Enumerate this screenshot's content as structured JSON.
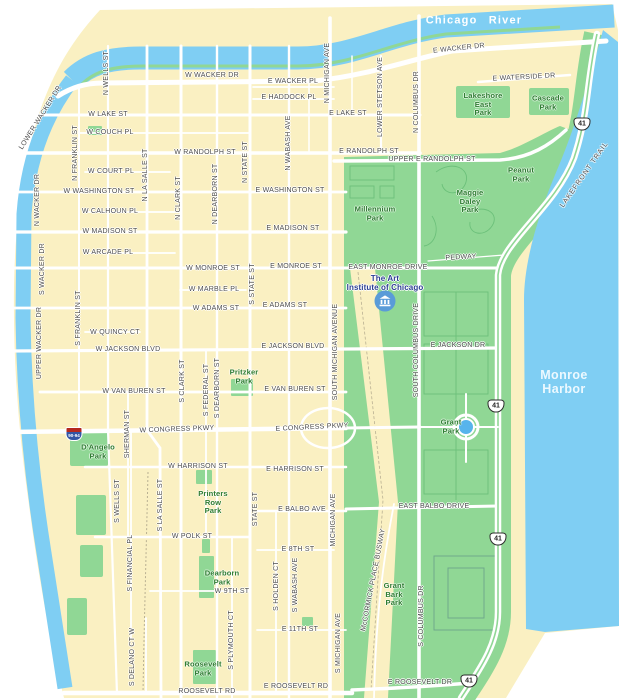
{
  "colors": {
    "land": "#FAF0C2",
    "water": "#7FCEF3",
    "park": "#90D795",
    "parkline": "#6CC07A",
    "road": "#FFFFFF",
    "bldg": "#6FA98C",
    "rail": "#B9B092",
    "stlbl": "#4E4E4E",
    "parklbl": "#2E7D32",
    "waterlbl": "#FFFFFF",
    "harborlbl": "#EDF9FF",
    "poilbl": "#2B3E92",
    "museum": "#5A9BD8",
    "shblue": "#3355A4",
    "shred": "#B5281F"
  },
  "map": {
    "labels": [
      {
        "t": "Chicago River",
        "x": 474,
        "y": 21,
        "r": 0,
        "c": "river"
      },
      {
        "t": "Monroe\nHarbor",
        "x": 564,
        "y": 382,
        "r": 0,
        "c": "harbor"
      },
      {
        "t": "W WACKER DR",
        "x": 212,
        "y": 76,
        "r": 0,
        "c": "st"
      },
      {
        "t": "E WACKER DR",
        "x": 459,
        "y": 49,
        "r": -6,
        "c": "st"
      },
      {
        "t": "E WACKER PL",
        "x": 293,
        "y": 82,
        "r": 0,
        "c": "st"
      },
      {
        "t": "E HADDOCK PL",
        "x": 289,
        "y": 98,
        "r": 0,
        "c": "st"
      },
      {
        "t": "E WATERSIDE DR",
        "x": 524,
        "y": 78,
        "r": -3,
        "c": "st"
      },
      {
        "t": "W LAKE ST",
        "x": 108,
        "y": 115,
        "r": 0,
        "c": "st"
      },
      {
        "t": "E LAKE ST",
        "x": 348,
        "y": 114,
        "r": 0,
        "c": "st"
      },
      {
        "t": "W COUCH PL",
        "x": 110,
        "y": 133,
        "r": 0,
        "c": "st"
      },
      {
        "t": "W RANDOLPH ST",
        "x": 205,
        "y": 153,
        "r": 0,
        "c": "st"
      },
      {
        "t": "E RANDOLPH ST",
        "x": 369,
        "y": 152,
        "r": 0,
        "c": "st"
      },
      {
        "t": "UPPER E RANDOLPH ST",
        "x": 432,
        "y": 160,
        "r": 0,
        "c": "st"
      },
      {
        "t": "W COURT PL",
        "x": 111,
        "y": 172,
        "r": 0,
        "c": "st"
      },
      {
        "t": "W WASHINGTON ST",
        "x": 99,
        "y": 192,
        "r": 0,
        "c": "st"
      },
      {
        "t": "E WASHINGTON ST",
        "x": 290,
        "y": 191,
        "r": 0,
        "c": "st"
      },
      {
        "t": "W CALHOUN PL",
        "x": 110,
        "y": 212,
        "r": 0,
        "c": "st"
      },
      {
        "t": "W MADISON ST",
        "x": 110,
        "y": 232,
        "r": 0,
        "c": "st"
      },
      {
        "t": "E MADISON ST",
        "x": 293,
        "y": 229,
        "r": 0,
        "c": "st"
      },
      {
        "t": "W ARCADE PL",
        "x": 108,
        "y": 253,
        "r": 0,
        "c": "st"
      },
      {
        "t": "W MONROE ST",
        "x": 213,
        "y": 269,
        "r": 0,
        "c": "st"
      },
      {
        "t": "E MONROE ST",
        "x": 296,
        "y": 267,
        "r": 0,
        "c": "st"
      },
      {
        "t": "EAST MONROE DRIVE",
        "x": 388,
        "y": 268,
        "r": 0,
        "c": "st"
      },
      {
        "t": "PEDWAY",
        "x": 461,
        "y": 258,
        "r": -3,
        "c": "st"
      },
      {
        "t": "W MARBLE PL",
        "x": 214,
        "y": 290,
        "r": 0,
        "c": "st"
      },
      {
        "t": "W ADAMS ST",
        "x": 216,
        "y": 309,
        "r": 0,
        "c": "st"
      },
      {
        "t": "E ADAMS ST",
        "x": 285,
        "y": 306,
        "r": 0,
        "c": "st"
      },
      {
        "t": "W QUINCY CT",
        "x": 115,
        "y": 333,
        "r": 0,
        "c": "st"
      },
      {
        "t": "W JACKSON BLVD",
        "x": 128,
        "y": 350,
        "r": 0,
        "c": "st"
      },
      {
        "t": "E JACKSON BLVD",
        "x": 293,
        "y": 347,
        "r": 0,
        "c": "st"
      },
      {
        "t": "E JACKSON DR",
        "x": 458,
        "y": 346,
        "r": 0,
        "c": "st"
      },
      {
        "t": "W VAN BUREN ST",
        "x": 134,
        "y": 392,
        "r": 0,
        "c": "st"
      },
      {
        "t": "E VAN BUREN ST",
        "x": 295,
        "y": 390,
        "r": 0,
        "c": "st"
      },
      {
        "t": "W CONGRESS PKWY",
        "x": 177,
        "y": 430,
        "r": -2,
        "c": "st"
      },
      {
        "t": "E CONGRESS PKWY",
        "x": 312,
        "y": 428,
        "r": -3,
        "c": "st"
      },
      {
        "t": "W HARRISON ST",
        "x": 198,
        "y": 467,
        "r": 0,
        "c": "st"
      },
      {
        "t": "E HARRISON ST",
        "x": 295,
        "y": 470,
        "r": 0,
        "c": "st"
      },
      {
        "t": "W POLK ST",
        "x": 192,
        "y": 537,
        "r": 0,
        "c": "st"
      },
      {
        "t": "E BALBO AVE",
        "x": 302,
        "y": 510,
        "r": 0,
        "c": "st"
      },
      {
        "t": "EAST BALBO DRIVE",
        "x": 434,
        "y": 507,
        "r": 0,
        "c": "st"
      },
      {
        "t": "E 8TH ST",
        "x": 298,
        "y": 550,
        "r": 0,
        "c": "st"
      },
      {
        "t": "W 9TH ST",
        "x": 232,
        "y": 592,
        "r": 0,
        "c": "st"
      },
      {
        "t": "E 11TH ST",
        "x": 300,
        "y": 630,
        "r": 0,
        "c": "st"
      },
      {
        "t": "ROOSEVELT RD",
        "x": 207,
        "y": 692,
        "r": 0,
        "c": "st"
      },
      {
        "t": "E ROOSEVELT RD",
        "x": 296,
        "y": 687,
        "r": 0,
        "c": "st"
      },
      {
        "t": "E ROOSEVELT DR",
        "x": 420,
        "y": 683,
        "r": 0,
        "c": "st"
      },
      {
        "t": "N WELLS ST",
        "x": 107,
        "y": 73,
        "r": -90,
        "c": "st"
      },
      {
        "t": "N FRANKLIN ST",
        "x": 76,
        "y": 153,
        "r": -90,
        "c": "st"
      },
      {
        "t": "N LA SALLE ST",
        "x": 146,
        "y": 175,
        "r": -90,
        "c": "st"
      },
      {
        "t": "N CLARK ST",
        "x": 179,
        "y": 198,
        "r": -90,
        "c": "st"
      },
      {
        "t": "N DEARBORN ST",
        "x": 216,
        "y": 194,
        "r": -90,
        "c": "st"
      },
      {
        "t": "N STATE ST",
        "x": 246,
        "y": 162,
        "r": -90,
        "c": "st"
      },
      {
        "t": "N WABASH AVE",
        "x": 289,
        "y": 143,
        "r": -90,
        "c": "st"
      },
      {
        "t": "N MICHIGAN AVE",
        "x": 328,
        "y": 73,
        "r": -90,
        "c": "st"
      },
      {
        "t": "LOWER STETSON AVE",
        "x": 381,
        "y": 97,
        "r": -90,
        "c": "st"
      },
      {
        "t": "N COLUMBUS DR",
        "x": 417,
        "y": 102,
        "r": -90,
        "c": "st"
      },
      {
        "t": "N WACKER DR",
        "x": 38,
        "y": 200,
        "r": -90,
        "c": "st"
      },
      {
        "t": "S WACKER DR",
        "x": 43,
        "y": 269,
        "r": -90,
        "c": "st"
      },
      {
        "t": "UPPER WACKER DR",
        "x": 40,
        "y": 343,
        "r": -90,
        "c": "st"
      },
      {
        "t": "LOWER WACKER DR",
        "x": 41,
        "y": 118,
        "r": -58,
        "c": "st"
      },
      {
        "t": "S FRANKLIN ST",
        "x": 79,
        "y": 318,
        "r": -90,
        "c": "st"
      },
      {
        "t": "S STATE ST",
        "x": 253,
        "y": 284,
        "r": -90,
        "c": "st"
      },
      {
        "t": "S CLARK ST",
        "x": 183,
        "y": 381,
        "r": -90,
        "c": "st"
      },
      {
        "t": "S FEDERAL ST",
        "x": 207,
        "y": 390,
        "r": -90,
        "c": "st"
      },
      {
        "t": "S DEARBORN ST",
        "x": 218,
        "y": 388,
        "r": -90,
        "c": "st"
      },
      {
        "t": "SHERMAN ST",
        "x": 128,
        "y": 434,
        "r": -90,
        "c": "st"
      },
      {
        "t": "S WELLS ST",
        "x": 118,
        "y": 501,
        "r": -90,
        "c": "st"
      },
      {
        "t": "S LA SALLE ST",
        "x": 161,
        "y": 505,
        "r": -90,
        "c": "st"
      },
      {
        "t": "S FINANCIAL PL",
        "x": 131,
        "y": 563,
        "r": -90,
        "c": "st"
      },
      {
        "t": "STATE ST",
        "x": 256,
        "y": 509,
        "r": -90,
        "c": "st"
      },
      {
        "t": "S HOLDEN CT",
        "x": 277,
        "y": 586,
        "r": -90,
        "c": "st"
      },
      {
        "t": "S WABASH AVE",
        "x": 296,
        "y": 585,
        "r": -90,
        "c": "st"
      },
      {
        "t": "SOUTH MICHIGAN AVENUE",
        "x": 336,
        "y": 352,
        "r": -90,
        "c": "st"
      },
      {
        "t": "MICHIGAN AVE",
        "x": 334,
        "y": 520,
        "r": -90,
        "c": "st"
      },
      {
        "t": "S MICHIGAN AVE",
        "x": 339,
        "y": 643,
        "r": -90,
        "c": "st"
      },
      {
        "t": "SOUTH COLUMBUS DRIVE",
        "x": 417,
        "y": 350,
        "r": -90,
        "c": "st"
      },
      {
        "t": "S COLUMBUS DR",
        "x": 422,
        "y": 616,
        "r": -90,
        "c": "st"
      },
      {
        "t": "S PLYMOUTH CT",
        "x": 232,
        "y": 640,
        "r": -90,
        "c": "st"
      },
      {
        "t": "S DELANO CT W",
        "x": 133,
        "y": 657,
        "r": -90,
        "c": "st"
      },
      {
        "t": "McCORMICK PLACE BUSWAY",
        "x": 374,
        "y": 580,
        "r": -79,
        "c": "st"
      },
      {
        "t": "LAKEFRONT TRAIL",
        "x": 585,
        "y": 175,
        "r": -55,
        "c": "trail"
      },
      {
        "t": "Lakeshore\nEast\nPark",
        "x": 483,
        "y": 105,
        "r": 0,
        "c": "park"
      },
      {
        "t": "Cascade\nPark",
        "x": 548,
        "y": 103,
        "r": 0,
        "c": "park"
      },
      {
        "t": "Peanut\nPark",
        "x": 521,
        "y": 175,
        "r": 0,
        "c": "park"
      },
      {
        "t": "Millennium\nPark",
        "x": 375,
        "y": 214,
        "r": 0,
        "c": "park"
      },
      {
        "t": "Maggie\nDaley\nPark",
        "x": 470,
        "y": 202,
        "r": 0,
        "c": "park"
      },
      {
        "t": "Pritzker\nPark",
        "x": 244,
        "y": 377,
        "r": 0,
        "c": "park"
      },
      {
        "t": "D'Angelo\nPark",
        "x": 98,
        "y": 452,
        "r": 0,
        "c": "park"
      },
      {
        "t": "Printers\nRow\nPark",
        "x": 213,
        "y": 503,
        "r": 0,
        "c": "park"
      },
      {
        "t": "Dearborn\nPark",
        "x": 222,
        "y": 578,
        "r": 0,
        "c": "park"
      },
      {
        "t": "Grant\nPark",
        "x": 451,
        "y": 427,
        "r": 0,
        "c": "park"
      },
      {
        "t": "Grant\nBark\nPark",
        "x": 394,
        "y": 595,
        "r": 0,
        "c": "park"
      },
      {
        "t": "Roosevelt\nPark",
        "x": 203,
        "y": 669,
        "r": 0,
        "c": "park"
      },
      {
        "t": "The Art\nInstitute of Chicago",
        "x": 385,
        "y": 283,
        "r": 0,
        "c": "poi"
      }
    ],
    "shields": [
      {
        "type": "us",
        "t": "41",
        "x": 582,
        "y": 124
      },
      {
        "type": "us",
        "t": "41",
        "x": 496,
        "y": 406
      },
      {
        "type": "us",
        "t": "41",
        "x": 498,
        "y": 539
      },
      {
        "type": "us",
        "t": "41",
        "x": 469,
        "y": 681
      },
      {
        "type": "int",
        "t": "90-94",
        "x": 74,
        "y": 434
      }
    ],
    "icons": [
      {
        "type": "museum-icon",
        "x": 385,
        "y": 301
      }
    ]
  }
}
